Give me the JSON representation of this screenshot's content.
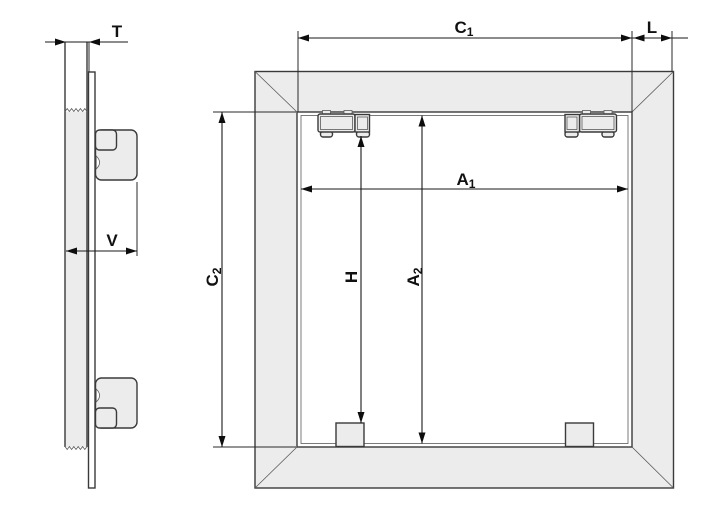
{
  "drawing": {
    "colors": {
      "background": "#ffffff",
      "outline": "#3a3a3a",
      "fill": "#ececec",
      "dimension_line": "#1a1a1a",
      "label": "#111111"
    },
    "side_view": {
      "dimensions": {
        "t": {
          "base": "T"
        },
        "v": {
          "base": "V"
        }
      }
    },
    "front_view": {
      "dimensions": {
        "c1": {
          "base": "C",
          "sub": "1"
        },
        "l": {
          "base": "L"
        },
        "a1": {
          "base": "A",
          "sub": "1"
        },
        "c2": {
          "base": "C",
          "sub": "2"
        },
        "h": {
          "base": "H"
        },
        "a2": {
          "base": "A",
          "sub": "2"
        }
      }
    }
  }
}
